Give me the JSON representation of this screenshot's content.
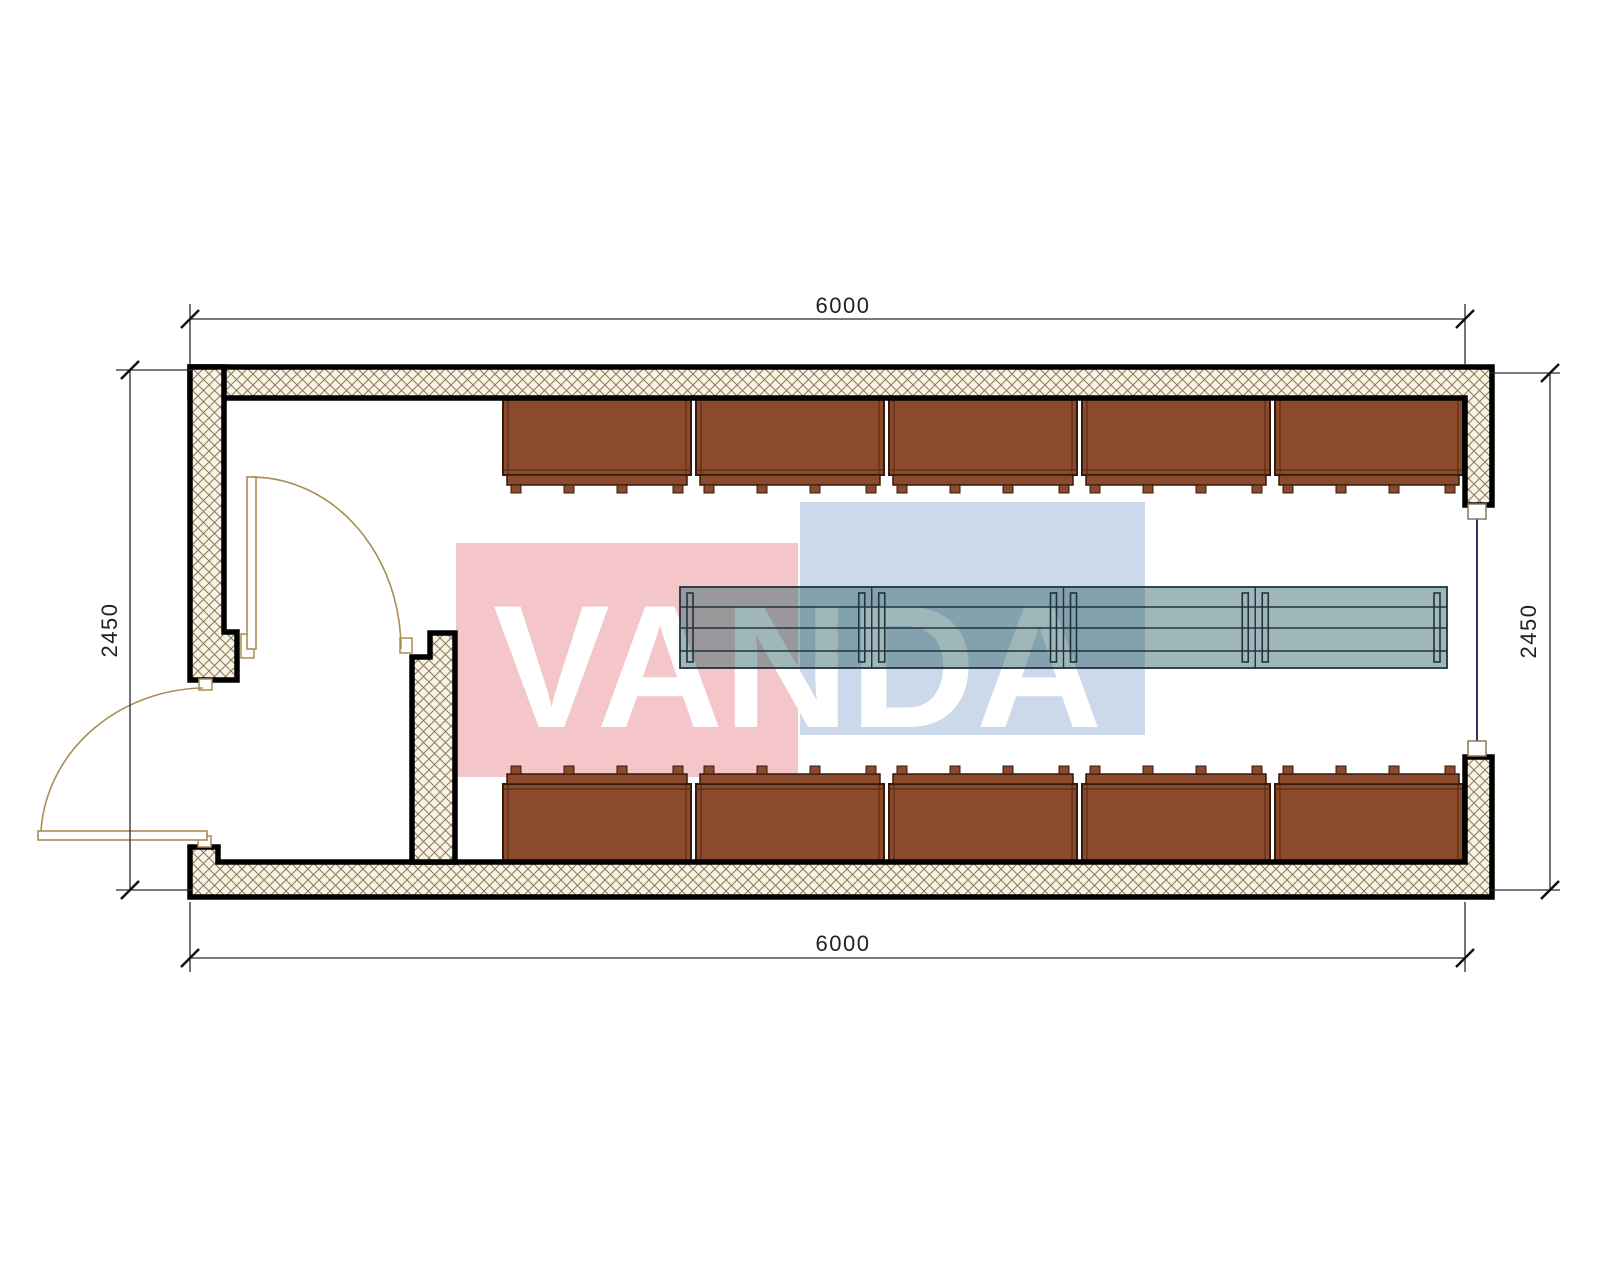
{
  "watermark": {
    "text": "VANDA",
    "red_color": "#f5c6c9",
    "blue_color": "#ccd9ea",
    "letter_color": "#ffffff"
  },
  "dimensions": {
    "top": "6000",
    "bottom": "6000",
    "left": "2450",
    "right": "2450"
  },
  "walls": {
    "hatch_bg": "#f8f3e4",
    "hatch_line": "#8a795c",
    "outline": "#000000",
    "window_line": "#343464",
    "post_fill": "#ffffff",
    "post_stroke": "#8a795c"
  },
  "doors": {
    "color": "#a98e54",
    "leaf_fill": "#ffffff"
  },
  "furniture": {
    "wardrobes": {
      "count_top": 5,
      "count_bottom": 5,
      "fill": "#8a4a2b",
      "outline": "#331a0c",
      "inner_line": "#5a2d15"
    },
    "table": {
      "sections": 4,
      "fill": "rgba(45,95,100,0.45)",
      "line_color": "#1f3340"
    }
  },
  "dim_style": {
    "line_color": "#2a2a2a",
    "tick_color": "#111111",
    "text_color": "#222222"
  }
}
